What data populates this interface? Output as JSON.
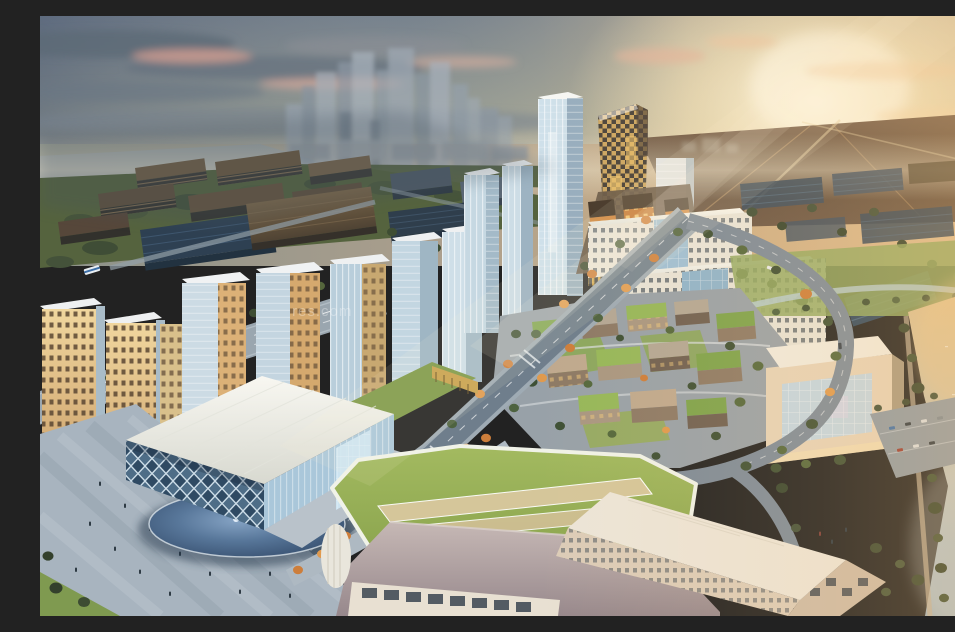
{
  "watermark": {
    "text": "res.com"
  },
  "palette": {
    "sky_cool": "#76828f",
    "sky_warm": "#efe2c2",
    "sun_glow": "#fff8e2",
    "cloud_slate": "#5c6875",
    "cloud_pink": "#d4a095",
    "distant_field_dark": "#63503f",
    "distant_field_warm": "#caa87c",
    "forest_green": "#4c5c3b",
    "tree_dark": "#3d4c33",
    "autumn_orange": "#d07c35",
    "autumn_amber": "#e09a4e",
    "lawn_green": "#8fa857",
    "glass_blue": "#b7cedd",
    "glass_deep": "#5f7d99",
    "checker_gold": "#d8ae62",
    "checker_dark": "#3e3a35",
    "white_building": "#edeae1",
    "beige_building": "#e2d2bb",
    "warm_lit_facade": "#e2b879",
    "bronze_office": "#6e5b44",
    "dark_glass": "#2f3f4e",
    "village_brown": "#9b8a74",
    "green_roof": "#7ea04a",
    "mauve_roof": "#ab9c9e",
    "asphalt": "#76848f",
    "plaza_gray": "#a8b4bf",
    "pool_blue": "#3e5775",
    "river_gold": "#dfc08c",
    "river_blue": "#9fb4c2"
  }
}
